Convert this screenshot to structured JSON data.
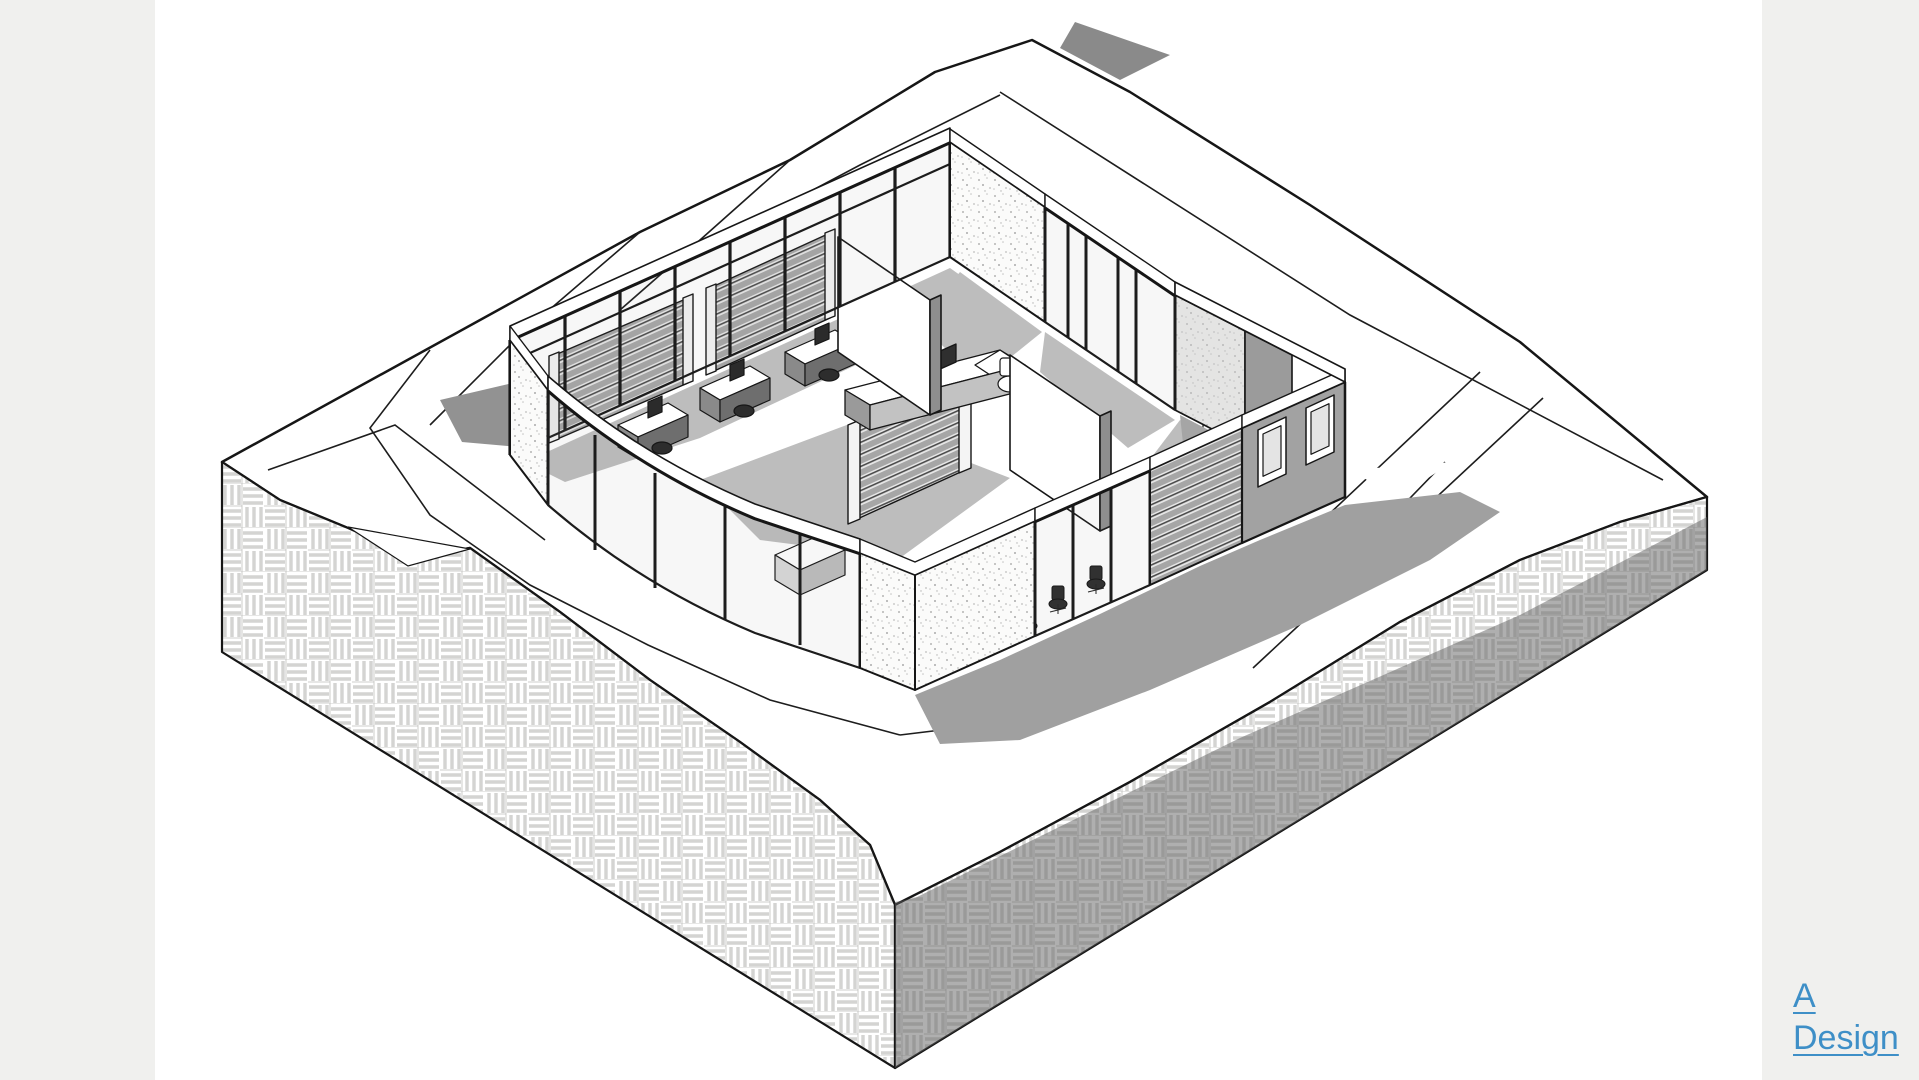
{
  "page": {
    "background_color": "#ffffff",
    "gutter_color": "#f0f0ee",
    "content_area": "white canvas with monochrome architectural axonometric rendering"
  },
  "brand": {
    "line1": "A",
    "line2": "Design",
    "link_color": "#3e8fc7"
  },
  "scene": {
    "type": "architectural-axonometric-cutaway",
    "subject": "single-storey office pavilion with curved glass curtain wall, louvered screens, desks, reception counter and WC rooms, cut open at roof level, sitting in a sunken court on a large site block",
    "site_block": "isometric earth block, top surface white with contour and terrace lines, vertical faces hatched with basket-weave pattern, dark shadow band cast across right face",
    "colors": {
      "line": "#161616",
      "hatch_line": "#d6d6d4",
      "cast_shadow": "#a0a0a0",
      "dark_shadow_band": "#7a7a7a",
      "wall_gray": "#a2a2a2",
      "louver_gray": "#9e9e9e",
      "stipple_dot": "#b9b9b9"
    }
  }
}
